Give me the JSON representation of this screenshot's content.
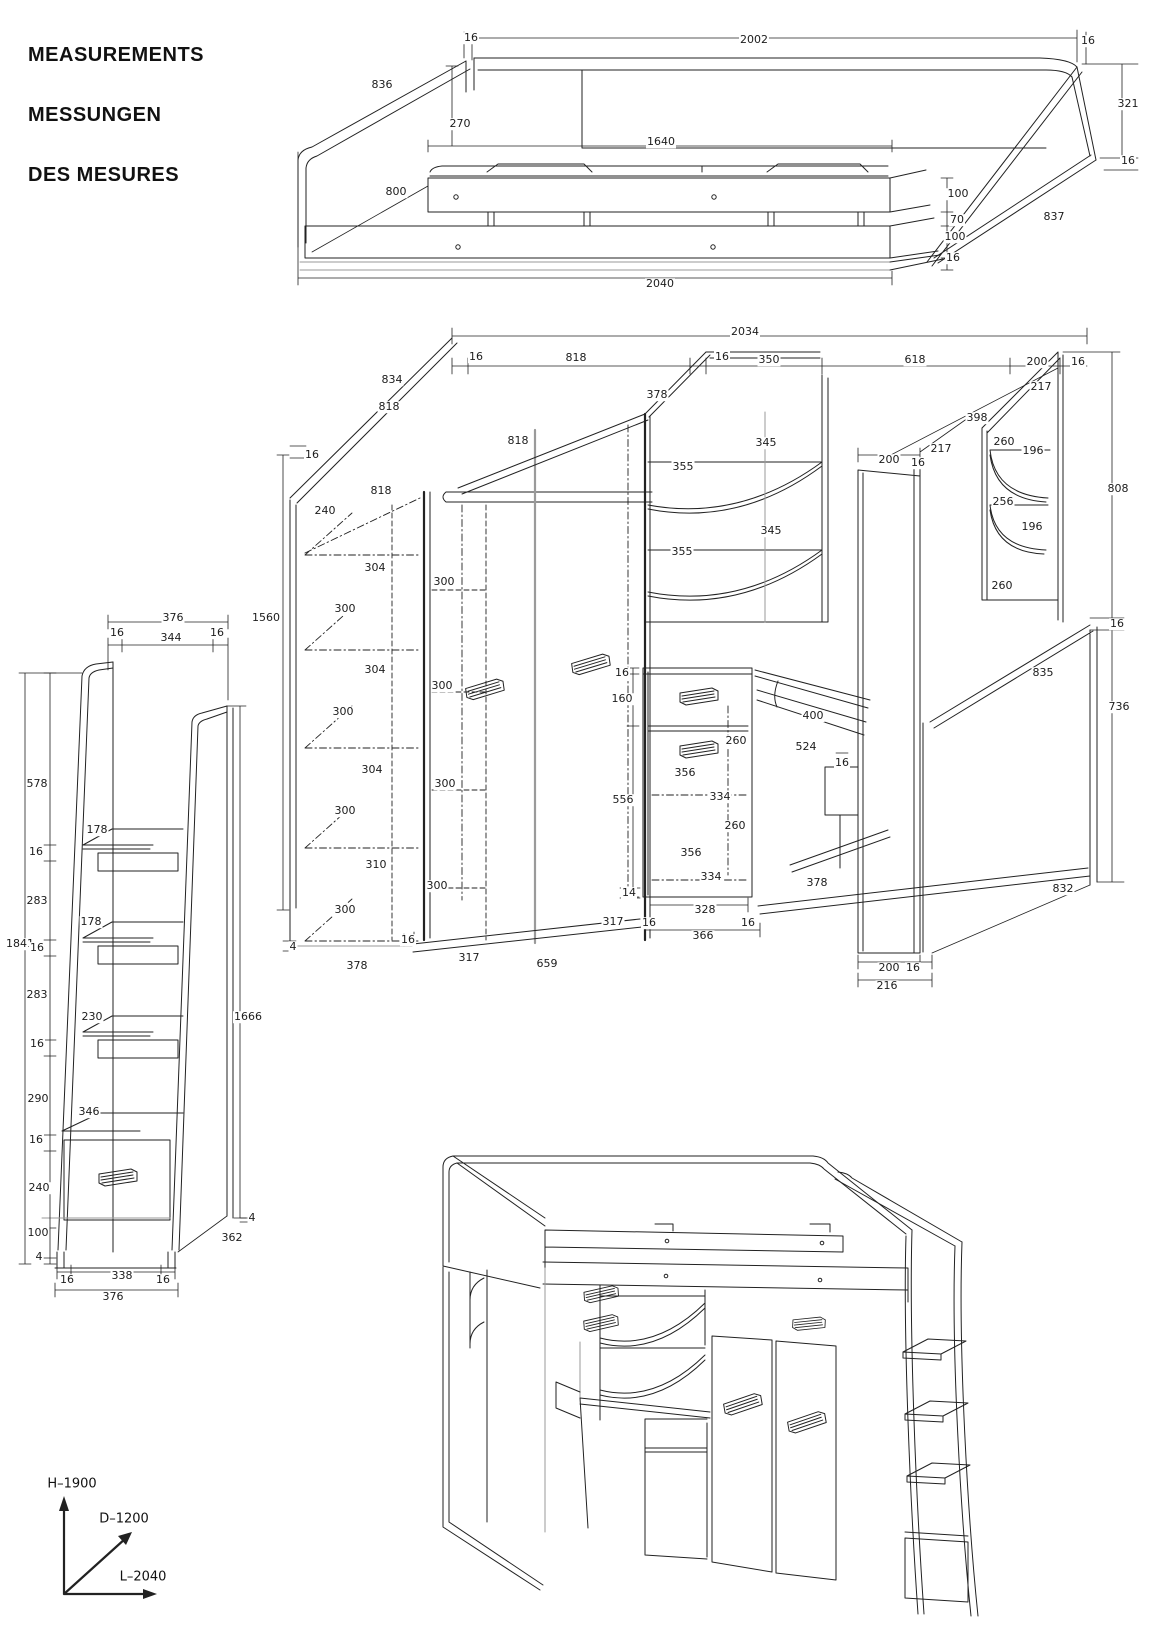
{
  "title": {
    "lines": [
      "MEASUREMENTS",
      "MESSUNGEN",
      "DES MESURES"
    ]
  },
  "axes": {
    "height_label": "H–1900",
    "depth_label": "D–1200",
    "length_label": "L–2040"
  },
  "colors": {
    "line": "#222222",
    "gray_line": "#9a9a9a",
    "background": "#ffffff",
    "text": "#1c1c1c"
  },
  "drawings": [
    {
      "id": "bed-base",
      "description": "Bed base perspective view with dimensions (mm)",
      "labels": [
        [
          "16",
          471,
          38
        ],
        [
          "2002",
          754,
          40
        ],
        [
          "16",
          1088,
          41
        ],
        [
          "836",
          382,
          85
        ],
        [
          "270",
          460,
          124
        ],
        [
          "1640",
          661,
          142
        ],
        [
          "321",
          1128,
          104
        ],
        [
          "16",
          1128,
          161
        ],
        [
          "800",
          396,
          192
        ],
        [
          "100",
          958,
          194
        ],
        [
          "70",
          957,
          220
        ],
        [
          "100",
          955,
          237
        ],
        [
          "16",
          953,
          258
        ],
        [
          "837",
          1054,
          217
        ],
        [
          "2040",
          660,
          284
        ]
      ]
    },
    {
      "id": "wardrobe-interior",
      "description": "Wardrobe, corner shelves and desk interior perspective with dimensions (mm)",
      "labels": [
        [
          "2034",
          745,
          332
        ],
        [
          "16",
          476,
          357
        ],
        [
          "818",
          576,
          358
        ],
        [
          "16",
          722,
          357
        ],
        [
          "350",
          769,
          360
        ],
        [
          "618",
          915,
          360
        ],
        [
          "200",
          1037,
          362
        ],
        [
          "16",
          1078,
          362
        ],
        [
          "834",
          392,
          380
        ],
        [
          "818",
          389,
          407
        ],
        [
          "378",
          657,
          395
        ],
        [
          "16",
          312,
          455
        ],
        [
          "818",
          518,
          441
        ],
        [
          "217",
          1041,
          387
        ],
        [
          "398",
          977,
          418
        ],
        [
          "260",
          1004,
          442
        ],
        [
          "196",
          1033,
          451
        ],
        [
          "256",
          1003,
          502
        ],
        [
          "196",
          1032,
          527
        ],
        [
          "260",
          1002,
          586
        ],
        [
          "808",
          1118,
          489
        ],
        [
          "345",
          766,
          443
        ],
        [
          "355",
          683,
          467
        ],
        [
          "345",
          771,
          531
        ],
        [
          "355",
          682,
          552
        ],
        [
          "200",
          889,
          460
        ],
        [
          "16",
          918,
          463
        ],
        [
          "217",
          941,
          449
        ],
        [
          "818",
          381,
          491
        ],
        [
          "240",
          325,
          511
        ],
        [
          "304",
          375,
          568
        ],
        [
          "300",
          444,
          582
        ],
        [
          "300",
          345,
          609
        ],
        [
          "1560",
          266,
          618
        ],
        [
          "304",
          375,
          670
        ],
        [
          "300",
          442,
          686
        ],
        [
          "300",
          343,
          712
        ],
        [
          "304",
          372,
          770
        ],
        [
          "300",
          445,
          784
        ],
        [
          "300",
          345,
          811
        ],
        [
          "310",
          376,
          865
        ],
        [
          "300",
          437,
          886
        ],
        [
          "300",
          345,
          910
        ],
        [
          "16",
          622,
          673
        ],
        [
          "160",
          622,
          699
        ],
        [
          "556",
          623,
          800
        ],
        [
          "260",
          736,
          741
        ],
        [
          "356",
          685,
          773
        ],
        [
          "334",
          720,
          797
        ],
        [
          "260",
          735,
          826
        ],
        [
          "356",
          691,
          853
        ],
        [
          "334",
          711,
          877
        ],
        [
          "400",
          813,
          716
        ],
        [
          "524",
          806,
          747
        ],
        [
          "16",
          842,
          763
        ],
        [
          "16",
          1117,
          624
        ],
        [
          "835",
          1043,
          673
        ],
        [
          "736",
          1119,
          707
        ],
        [
          "378",
          817,
          883
        ],
        [
          "832",
          1063,
          889
        ],
        [
          "4",
          293,
          947
        ],
        [
          "378",
          357,
          966
        ],
        [
          "16",
          408,
          940
        ],
        [
          "317",
          469,
          958
        ],
        [
          "659",
          547,
          964
        ],
        [
          "14",
          629,
          893
        ],
        [
          "317",
          613,
          922
        ],
        [
          "16",
          649,
          923
        ],
        [
          "328",
          705,
          910
        ],
        [
          "16",
          748,
          923
        ],
        [
          "366",
          703,
          936
        ],
        [
          "200",
          889,
          968
        ],
        [
          "16",
          913,
          968
        ],
        [
          "216",
          887,
          986
        ]
      ]
    },
    {
      "id": "ladder-side",
      "description": "Step ladder / shelf column side view with dimensions (mm)",
      "labels": [
        [
          "376",
          173,
          618
        ],
        [
          "16",
          117,
          633
        ],
        [
          "344",
          171,
          638
        ],
        [
          "16",
          217,
          633
        ],
        [
          "578",
          37,
          784
        ],
        [
          "178",
          97,
          830
        ],
        [
          "16",
          36,
          852
        ],
        [
          "283",
          37,
          901
        ],
        [
          "178",
          91,
          922
        ],
        [
          "1841",
          20,
          944
        ],
        [
          "16",
          37,
          948
        ],
        [
          "283",
          37,
          995
        ],
        [
          "230",
          92,
          1017
        ],
        [
          "16",
          37,
          1044
        ],
        [
          "290",
          38,
          1099
        ],
        [
          "346",
          89,
          1112
        ],
        [
          "16",
          36,
          1140
        ],
        [
          "240",
          39,
          1188
        ],
        [
          "100",
          38,
          1233
        ],
        [
          "4",
          39,
          1257
        ],
        [
          "1666",
          248,
          1017
        ],
        [
          "4",
          252,
          1218
        ],
        [
          "362",
          232,
          1238
        ],
        [
          "16",
          67,
          1280
        ],
        [
          "338",
          122,
          1276
        ],
        [
          "16",
          163,
          1280
        ],
        [
          "376",
          113,
          1297
        ]
      ]
    },
    {
      "id": "assembled-unit",
      "description": "Assembled loft bed with wardrobe, desk and step ladder (3D view, no dimensions)",
      "labels": []
    }
  ]
}
